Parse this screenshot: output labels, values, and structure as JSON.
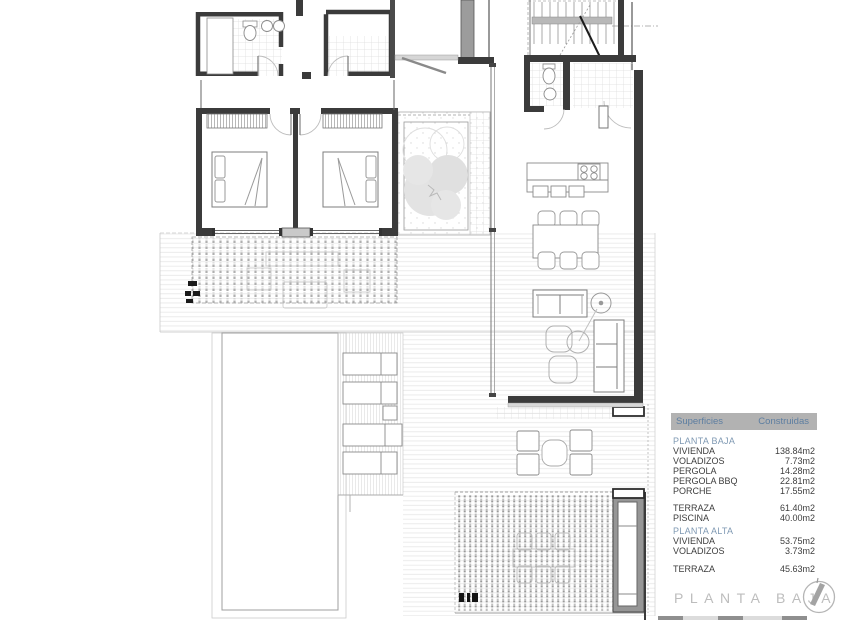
{
  "area_table": {
    "header": {
      "surfaces": "Superficies",
      "built": "Construidas"
    },
    "groups": [
      {
        "title": "PLANTA BAJA",
        "rows": [
          {
            "label": "VIVIENDA",
            "value": "138.84m2"
          },
          {
            "label": "VOLADIZOS",
            "value": "7.73m2"
          },
          {
            "label": "PERGOLA",
            "value": "14.28m2"
          },
          {
            "label": "PERGOLA BBQ",
            "value": "22.81m2"
          },
          {
            "label": "PORCHE",
            "value": "17.55m2"
          }
        ]
      },
      {
        "title": "",
        "rows": [
          {
            "label": "TERRAZA",
            "value": "61.40m2"
          },
          {
            "label": "PISCINA",
            "value": "40.00m2"
          }
        ]
      },
      {
        "title": "PLANTA ALTA",
        "rows": [
          {
            "label": "VIVIENDA",
            "value": "53.75m2"
          },
          {
            "label": "VOLADIZOS",
            "value": "3.73m2"
          }
        ]
      },
      {
        "title": "",
        "rows": [
          {
            "label": "TERRAZA",
            "value": "45.63m2"
          }
        ]
      }
    ]
  },
  "title_block": {
    "footer_title": "PLANTA BAJA",
    "compass_icon": "north-indicator-icon"
  },
  "colors": {
    "header_bg": "#b2b2b2",
    "header_text": "#5d7ea1",
    "section_text": "#7f99b3",
    "row_text": "#3d3d3d",
    "footer_text": "#bdbdbd",
    "wall": "#3b3b3b"
  }
}
